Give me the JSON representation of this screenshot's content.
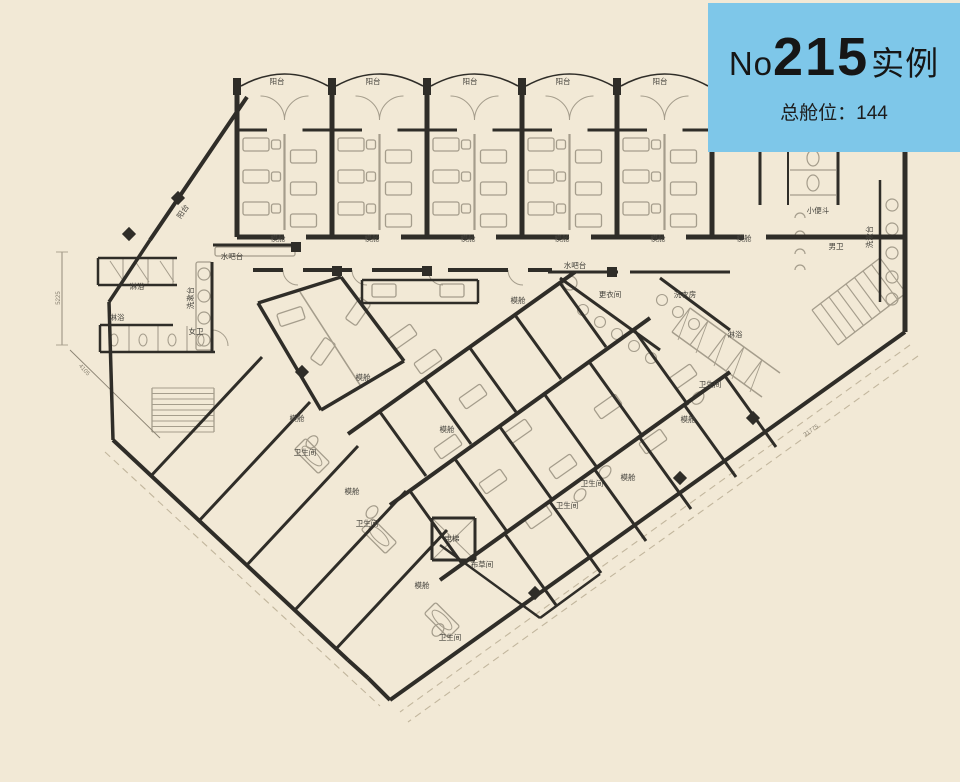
{
  "badge": {
    "prefix": "No",
    "number": "215",
    "suffix": "实例",
    "subtitle": "总舱位：144",
    "bg_color": "#7ec7e9",
    "text_color": "#161616"
  },
  "canvas": {
    "background": "#f2e9d6",
    "wall_color": "#2f2d28",
    "fixture_color": "#a59d8c",
    "dash_color": "#c2b69d",
    "label_color": "#44423c",
    "dim_color": "#8a8272"
  },
  "floorplan": {
    "balcony_count": 5,
    "labels": [
      {
        "t": "阳台",
        "x": 277,
        "y": 84
      },
      {
        "t": "阳台",
        "x": 373,
        "y": 84
      },
      {
        "t": "阳台",
        "x": 470,
        "y": 84
      },
      {
        "t": "阳台",
        "x": 563,
        "y": 84
      },
      {
        "t": "阳台",
        "x": 660,
        "y": 84
      },
      {
        "t": "阳台",
        "x": 185,
        "y": 213,
        "r": -56
      },
      {
        "t": "模舱",
        "x": 278,
        "y": 241
      },
      {
        "t": "模舱",
        "x": 372,
        "y": 241
      },
      {
        "t": "模舱",
        "x": 468,
        "y": 241
      },
      {
        "t": "模舱",
        "x": 562,
        "y": 241
      },
      {
        "t": "模舱",
        "x": 658,
        "y": 241
      },
      {
        "t": "模舱",
        "x": 744,
        "y": 241
      },
      {
        "t": "模舱",
        "x": 297,
        "y": 421
      },
      {
        "t": "模舱",
        "x": 352,
        "y": 494
      },
      {
        "t": "模舱",
        "x": 363,
        "y": 380
      },
      {
        "t": "模舱",
        "x": 447,
        "y": 432
      },
      {
        "t": "模舱",
        "x": 518,
        "y": 303
      },
      {
        "t": "模舱",
        "x": 628,
        "y": 480
      },
      {
        "t": "模舱",
        "x": 688,
        "y": 422
      },
      {
        "t": "模舱",
        "x": 422,
        "y": 588
      },
      {
        "t": "小便斗",
        "x": 818,
        "y": 213
      },
      {
        "t": "洗漱台",
        "x": 872,
        "y": 237,
        "r": -90
      },
      {
        "t": "男卫",
        "x": 836,
        "y": 249
      },
      {
        "t": "洗漱台",
        "x": 193,
        "y": 298,
        "r": -90
      },
      {
        "t": "女卫",
        "x": 196,
        "y": 334
      },
      {
        "t": "淋浴",
        "x": 137,
        "y": 289
      },
      {
        "t": "淋浴",
        "x": 117,
        "y": 320
      },
      {
        "t": "淋浴",
        "x": 735,
        "y": 337
      },
      {
        "t": "水吧台",
        "x": 232,
        "y": 259
      },
      {
        "t": "水吧台",
        "x": 575,
        "y": 268
      },
      {
        "t": "更衣间",
        "x": 610,
        "y": 297
      },
      {
        "t": "洗衣房",
        "x": 685,
        "y": 297
      },
      {
        "t": "布草间",
        "x": 482,
        "y": 567
      },
      {
        "t": "电梯",
        "x": 452,
        "y": 541
      },
      {
        "t": "卫生间",
        "x": 305,
        "y": 455
      },
      {
        "t": "卫生间",
        "x": 367,
        "y": 526
      },
      {
        "t": "卫生间",
        "x": 450,
        "y": 640
      },
      {
        "t": "卫生间",
        "x": 567,
        "y": 508
      },
      {
        "t": "卫生间",
        "x": 592,
        "y": 486
      },
      {
        "t": "卫生间",
        "x": 710,
        "y": 387
      }
    ],
    "dimensions": [
      {
        "t": "5225",
        "x": 60,
        "y": 298,
        "r": -90
      },
      {
        "t": "4105",
        "x": 83,
        "y": 371,
        "r": 48
      },
      {
        "t": "31775",
        "x": 812,
        "y": 432,
        "r": -35
      }
    ]
  }
}
